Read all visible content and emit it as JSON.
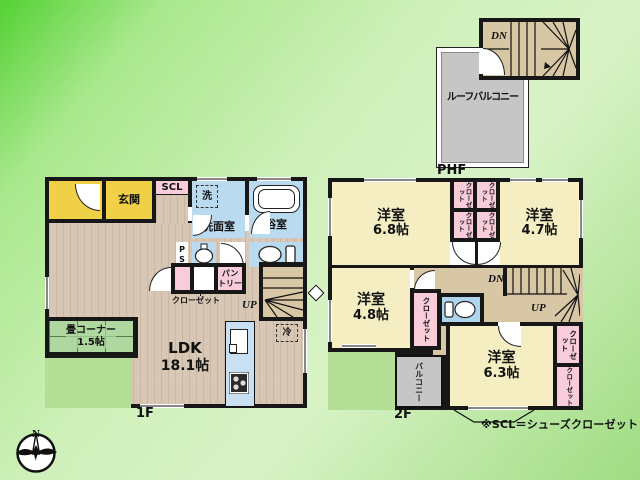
{
  "compass": {
    "north": "N"
  },
  "note": {
    "scl_definition": "※SCL＝シューズクローゼット"
  },
  "colors": {
    "wall": "#171717",
    "floor_wood": "#d9c7b6",
    "entrance_yellow": "#f0d047",
    "room_pale_yellow": "#f4eec2",
    "wet_area_blue": "#badaf0",
    "closet_pink": "#f8ccd8",
    "tatami_green": "#aed89f",
    "balcony_gray": "#c6c6c6",
    "stair_tan": "#d8c7a4",
    "background_green": "#a9e88d"
  },
  "floor_1f": {
    "label": "1F",
    "entrance": "玄関",
    "shoe_closet": "SCL",
    "washer": "洗",
    "washroom": "洗面室",
    "bathroom": "浴室",
    "pipe_space": "PS",
    "pantry_line1": "パン",
    "pantry_line2": "トリー",
    "closet": "クローゼット",
    "stairs_up": "UP",
    "fridge": "冷",
    "tatami_corner": "畳コーナー",
    "tatami_size": "1.5帖",
    "ldk": "LDK",
    "ldk_size": "18.1帖"
  },
  "floor_2f": {
    "label": "2F",
    "room_68": {
      "name": "洋室",
      "size": "6.8帖"
    },
    "room_47": {
      "name": "洋室",
      "size": "4.7帖"
    },
    "room_48": {
      "name": "洋室",
      "size": "4.8帖"
    },
    "room_63": {
      "name": "洋室",
      "size": "6.3帖"
    },
    "closet": "クローゼット",
    "stairs_down": "DN",
    "stairs_up": "UP",
    "balcony": "バルコニー"
  },
  "floor_phf": {
    "label": "PHF",
    "roof_balcony": "ルーフバルコニー",
    "stairs_down": "DN"
  }
}
